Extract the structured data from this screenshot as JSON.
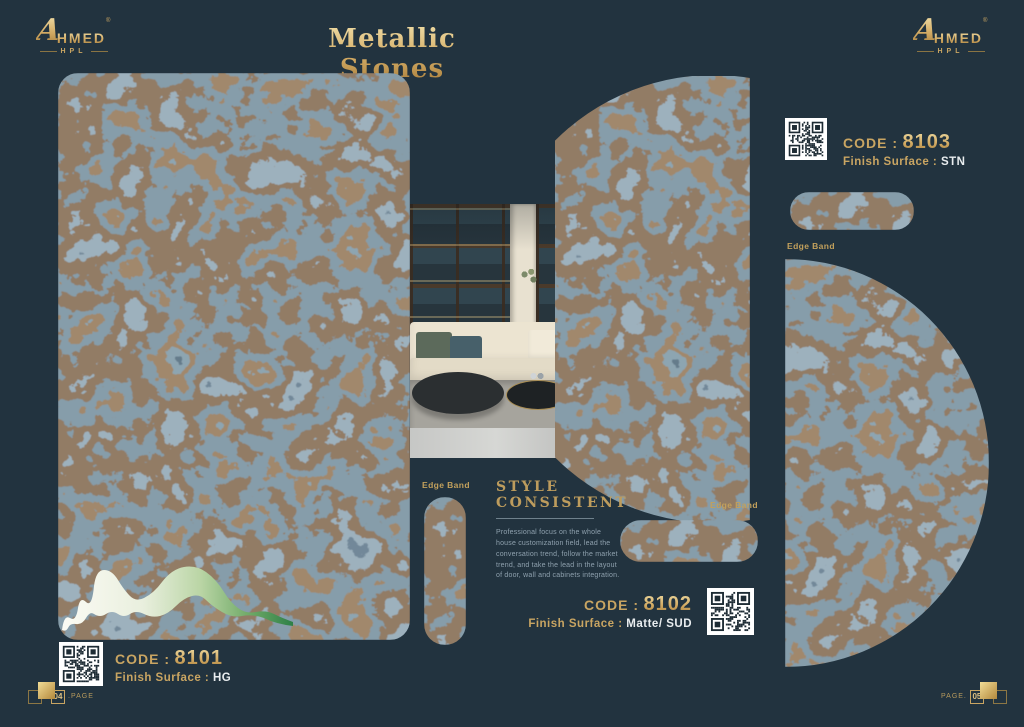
{
  "page": {
    "title": "Metallic Stones"
  },
  "brand": {
    "initial": "A",
    "rest": "HMED",
    "registered": "®",
    "sub": "HPL"
  },
  "products": {
    "p8101": {
      "code_label": "CODE :",
      "code": "8101",
      "finish_label": "Finish Surface :",
      "finish": "HG"
    },
    "p8102": {
      "code_label": "CODE :",
      "code": "8102",
      "finish_label": "Finish Surface :",
      "finish": "Matte/ SUD"
    },
    "p8103": {
      "code_label": "CODE :",
      "code": "8103",
      "finish_label": "Finish Surface :",
      "finish": "STN"
    }
  },
  "labels": {
    "edge_band": "Edge Band"
  },
  "style_block": {
    "line1": "STYLE",
    "line2": "CONSISTENT",
    "paragraph": "Professional focus on the whole house customization field, lead the conversation trend, follow the market trend, and take the lead in the layout of door, wall and cabinets integration."
  },
  "pagination": {
    "left_num": "04",
    "left_label": ".PAGE",
    "right_label": "PAGE.",
    "right_num": "05"
  },
  "colors": {
    "background": "#22333f",
    "gold": "#c9a562",
    "value_text": "#e9edef"
  }
}
